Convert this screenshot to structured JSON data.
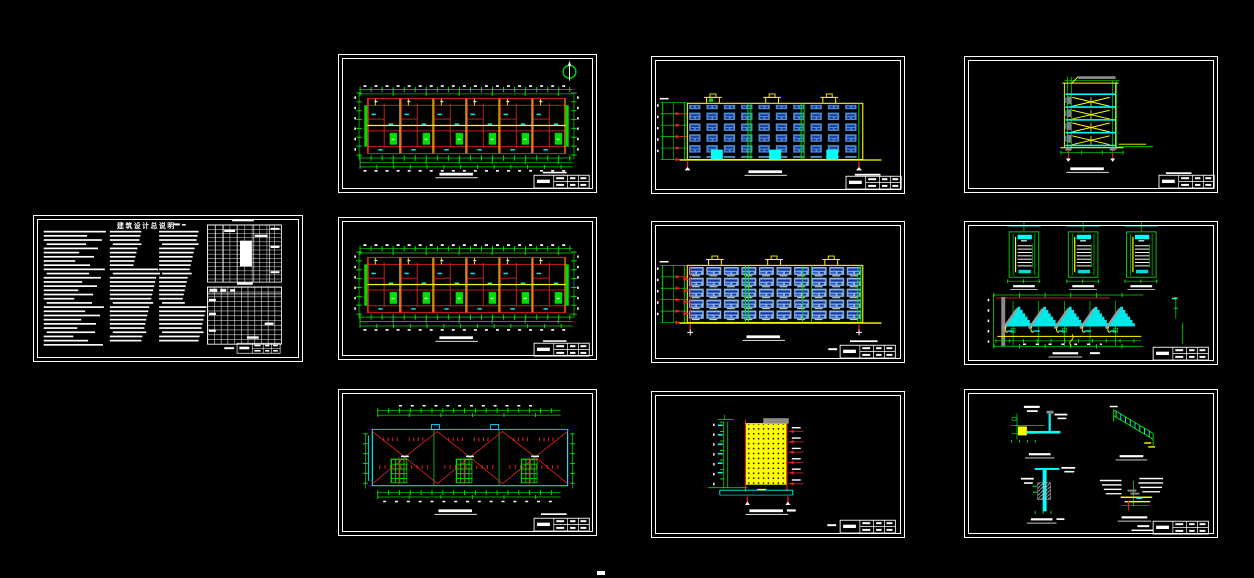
{
  "canvas": {
    "background": "#000000",
    "width": 1254,
    "height": 578
  },
  "palette": {
    "sheet_border": "#ffffff",
    "wall_red": "#e02020",
    "dimension_green": "#00dd00",
    "highlight_yellow": "#ffff00",
    "fitting_cyan": "#00ffff",
    "window_blue": "#4f8fd0",
    "window_blue_dark": "#15309c",
    "window_blue_light": "#8ab8e8",
    "hatch_gray": "#8a8a8a"
  },
  "notes_sheet": {
    "title": "建筑设计总说明"
  },
  "sheets": [
    {
      "id": "general-notes",
      "kind": "text-notes-sheet"
    },
    {
      "id": "floor-plan-1",
      "kind": "floor-plan"
    },
    {
      "id": "front-elevation",
      "kind": "elevation"
    },
    {
      "id": "building-section",
      "kind": "section"
    },
    {
      "id": "floor-plan-2",
      "kind": "floor-plan"
    },
    {
      "id": "rear-elevation",
      "kind": "elevation"
    },
    {
      "id": "stair-details",
      "kind": "stair-plans-and-section"
    },
    {
      "id": "roof-plan",
      "kind": "roof-plan"
    },
    {
      "id": "side-elevation",
      "kind": "gable-elevation"
    },
    {
      "id": "construction-details",
      "kind": "detail-callouts"
    }
  ]
}
